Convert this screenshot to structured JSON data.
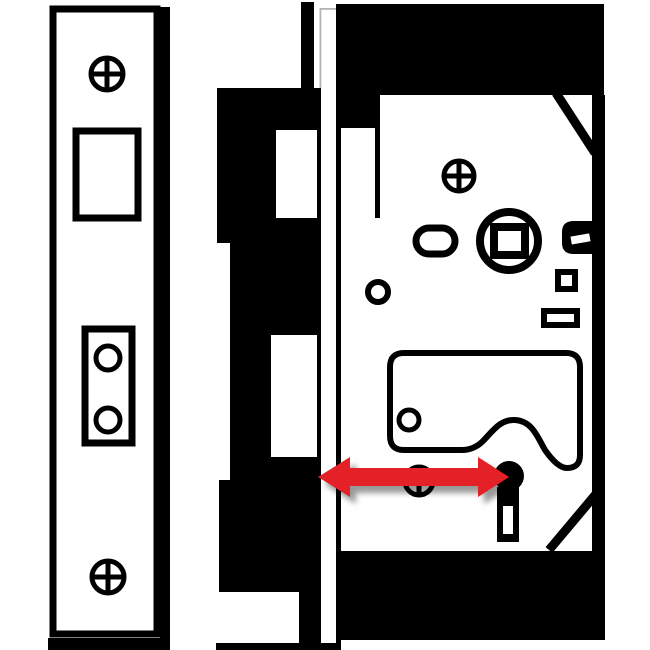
{
  "diagram": {
    "type": "technical-illustration",
    "subject": "mortice sash lock backset measurement",
    "measurement": {
      "name": "backset",
      "indicator": "double-headed horizontal arrow",
      "from": "lock faceplate (forend) edge",
      "to": "keyhole centre"
    },
    "parts": {
      "strike_plate": "strike / keep plate with two fixing screws, latch opening and deadbolt keep box",
      "door_edge": "black cut-away silhouette of the door edge",
      "forend": "lock forend (faceplate) seen edge-on",
      "lock_case": "mortice lock case with fixing screw, spindle follower, lever plate and keyhole"
    }
  },
  "colors": {
    "ink": "#000000",
    "background": "#ffffff",
    "arrow": "#e32127",
    "hairline": "#b3b3b3"
  }
}
